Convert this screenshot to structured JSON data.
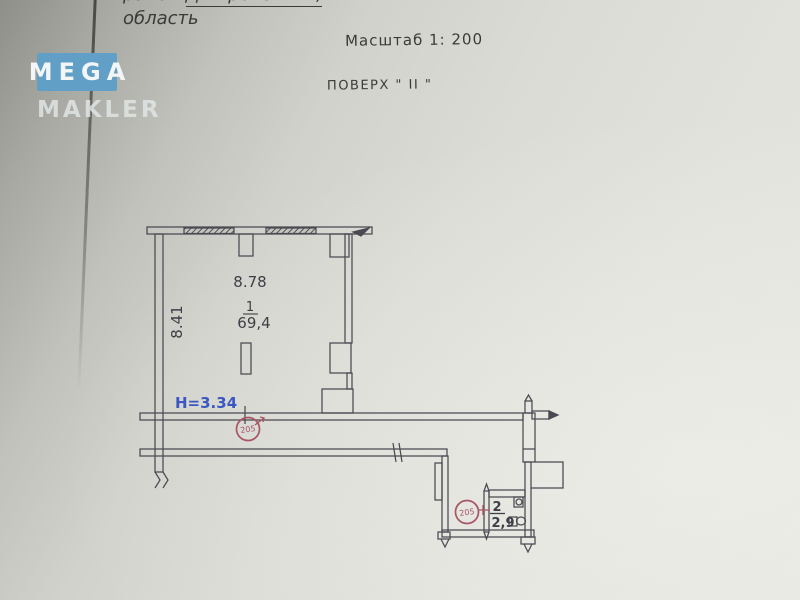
{
  "watermark": {
    "line1": "MEGA",
    "line2": "MAKLER",
    "badge_color": "#619fc6"
  },
  "header": {
    "location_prefix": "район ",
    "location_district": "Дніпровський,",
    "location_line2": "область",
    "scale_label": "Масштаб 1: 200",
    "floor_label": "ПОВЕРХ \" ІІ \""
  },
  "plan": {
    "rooms": [
      {
        "number": "1",
        "area": "69,4",
        "width": "8.78",
        "depth": "8.41",
        "height_note": "H=3.34"
      },
      {
        "number": "2",
        "area": "2,9"
      }
    ],
    "stamps": [
      {
        "text": "205"
      },
      {
        "text": "205"
      }
    ],
    "colors": {
      "line": "#4a4a52",
      "height_text": "#3a57c4",
      "stamp": "#a85563",
      "text": "#3e3e46"
    }
  }
}
